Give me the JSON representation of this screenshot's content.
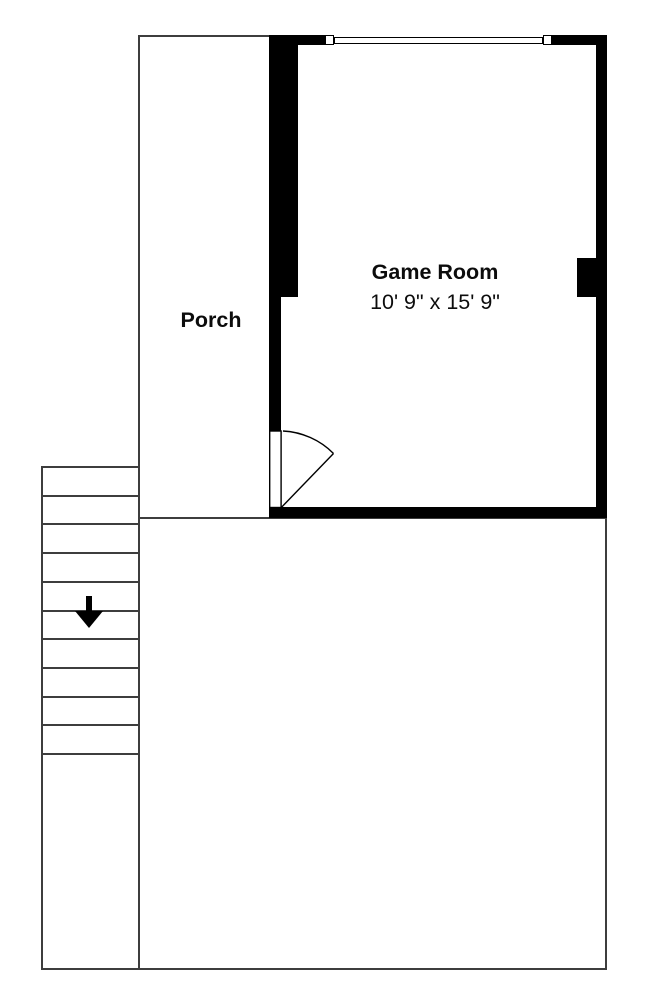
{
  "rooms": {
    "game_room": {
      "name": "Game Room",
      "dimensions": "10' 9\" x 15' 9\""
    },
    "porch": {
      "name": "Porch"
    }
  },
  "stairs": {
    "tread_count": 11,
    "direction": "down",
    "icon": "down-arrow-icon"
  },
  "features": {
    "window": "window-in-top-wall",
    "door": "door-with-swing-arc"
  },
  "colors": {
    "wall": "#000000",
    "thin_line": "#3d3d3d",
    "background": "#ffffff",
    "text": "#0c0c0c"
  }
}
